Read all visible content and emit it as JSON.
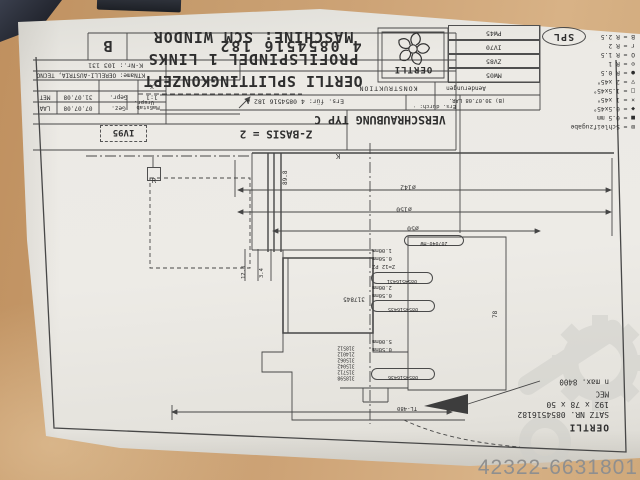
{
  "photo": {
    "watermark_text": "42322-6631801",
    "stamp": "SPL"
  },
  "header": {
    "line1": "OERTLI SPLITTINGKONZEPT",
    "line2": "PROFILSPINDEL 1 LINKS",
    "line3": "MASCHINE: SCM WINDOR"
  },
  "logo": {
    "brand": "OERTLI"
  },
  "title_strip": {
    "code": "4 0854516 182",
    "rev": "B"
  },
  "rev_boxes": [
    "PW45",
    "IV70",
    "ZV85",
    "MW05"
  ],
  "legend": {
    "items": [
      "B = R 2.5",
      "r = R 2",
      "O = R 1.5",
      "⊙ = R 1",
      "● = R 0.5",
      "▽ = 2 x45°",
      "□ = 1.5x45°",
      "× = 1 x45°",
      "◆ = 0.5x45°",
      "■ = 0.5 mm",
      "⊠ = Schleifzugabe"
    ]
  },
  "title_block": {
    "k_nr": "K-Nr.: 103 131",
    "kt_name": "KTName: OERELLI-AUSTRIA, TECNO",
    "scale_mark": "X",
    "scale_value": "1:1",
    "scale_label": "Maßstab",
    "checked_label": "Gepr.",
    "checked_date": "31.07.08",
    "checked_by": "MET",
    "drawn_label": "Gez.",
    "drawn_date": "07.07.08",
    "drawn_by": "LAA",
    "urspr": "Urspr.",
    "ers_fuer": "Ers. für: 4 0854516 182 A",
    "ers_durch": "Ers. durch: ·",
    "konstruktion": "KONSTRUKTION",
    "aenderungen": "Aenderungen",
    "rev_note": "(B) 30.07.08 LAR.",
    "type_note": "VERSCHRAUBUNG TYP C",
    "z_basis": "Z-BASIS = 2",
    "iv_box": "IV95"
  },
  "footer": {
    "brand": "OERTLI",
    "satz": "SATZ NR. 0854516182",
    "dims": "192 x 78 x 50",
    "mec": "MEC",
    "nmax": "n max. 8400"
  },
  "dims": {
    "d142": "ø142",
    "d150": "ø150",
    "d50": "ø50",
    "w898": "89.8",
    "w78": "78",
    "d123": "12.3",
    "d34": "3.4",
    "tl": "TL-480",
    "r_marker": "R",
    "k_marker": "K"
  },
  "part_labels": {
    "oval_top": "207040-HW",
    "mm_1": "1.00mm",
    "mm_2": "0.50mm",
    "z_pz": "Z=12 PZ",
    "oval_431": "0854516431",
    "mm_3": "2.00mm",
    "mm_4": "0.50mm",
    "oval_435": "0854516435",
    "mm_5": "5.00mm",
    "mm_6": "0.50mm",
    "oval_436": "0854516436",
    "body": "317845",
    "stack": [
      "318512",
      "214012",
      "315062",
      "315042",
      "315712",
      "318598"
    ]
  }
}
